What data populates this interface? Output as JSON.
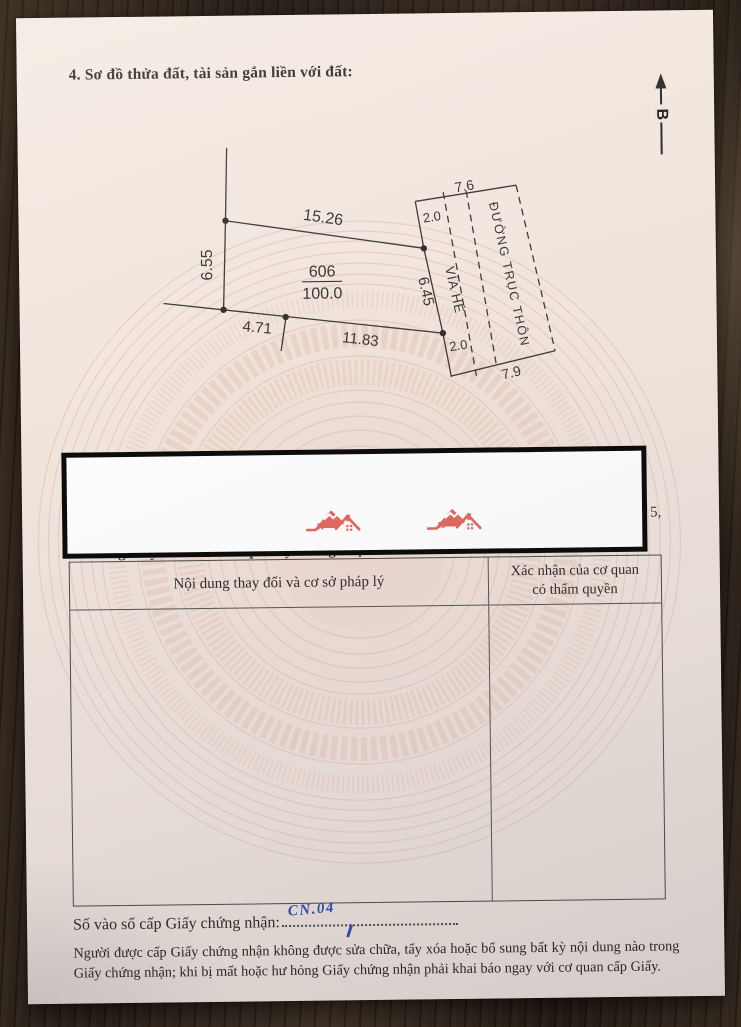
{
  "page": {
    "section4_title": "4. Sơ đồ thửa đất, tài sản gắn liền với đất:",
    "north_label": "B"
  },
  "diagram": {
    "parcel_number": "606",
    "parcel_area": "100.0",
    "edge_top": "15.26",
    "edge_left": "6.55",
    "edge_bottom_1": "4.71",
    "edge_bottom_2": "11.83",
    "edge_right": "6.45",
    "sidewalk_label": "VỈA HÈ",
    "sidewalk_top_width": "2.0",
    "sidewalk_bottom_width": "2.0",
    "road_label": "ĐƯỜNG TRỤC THÔN",
    "road_top_width": "7.6",
    "road_bottom_width": "7.9"
  },
  "redaction": {
    "visible_fragment": "5,",
    "covered_heading": "5. Những thay đổi sau khi cấp Giấy chứng nhận:"
  },
  "changes_table": {
    "col_change_header": "Nội dung thay đổi và cơ sở pháp lý",
    "col_confirm_header_line1": "Xác nhận của cơ quan",
    "col_confirm_header_line2": "có thẩm quyền"
  },
  "issue": {
    "label": "Số vào sổ cấp Giấy chứng nhận:",
    "handwritten_value": "CN.04"
  },
  "footer": {
    "note": "Người được cấp Giấy chứng nhận không được sửa chữa, tẩy xóa hoặc bổ sung bất kỳ nội dung nào trong Giấy chứng nhận; khi bị mất hoặc hư hỏng Giấy chứng nhận phải khai báo ngay với cơ quan cấp Giấy."
  },
  "colors": {
    "paper": "#f2e7df",
    "wood": "#2c231c",
    "watermark_pink": "#dbb5aa",
    "logo_red": "#e0685f",
    "handwriting_blue": "#2e4daf",
    "diagram_line": "#3c3c3c"
  }
}
